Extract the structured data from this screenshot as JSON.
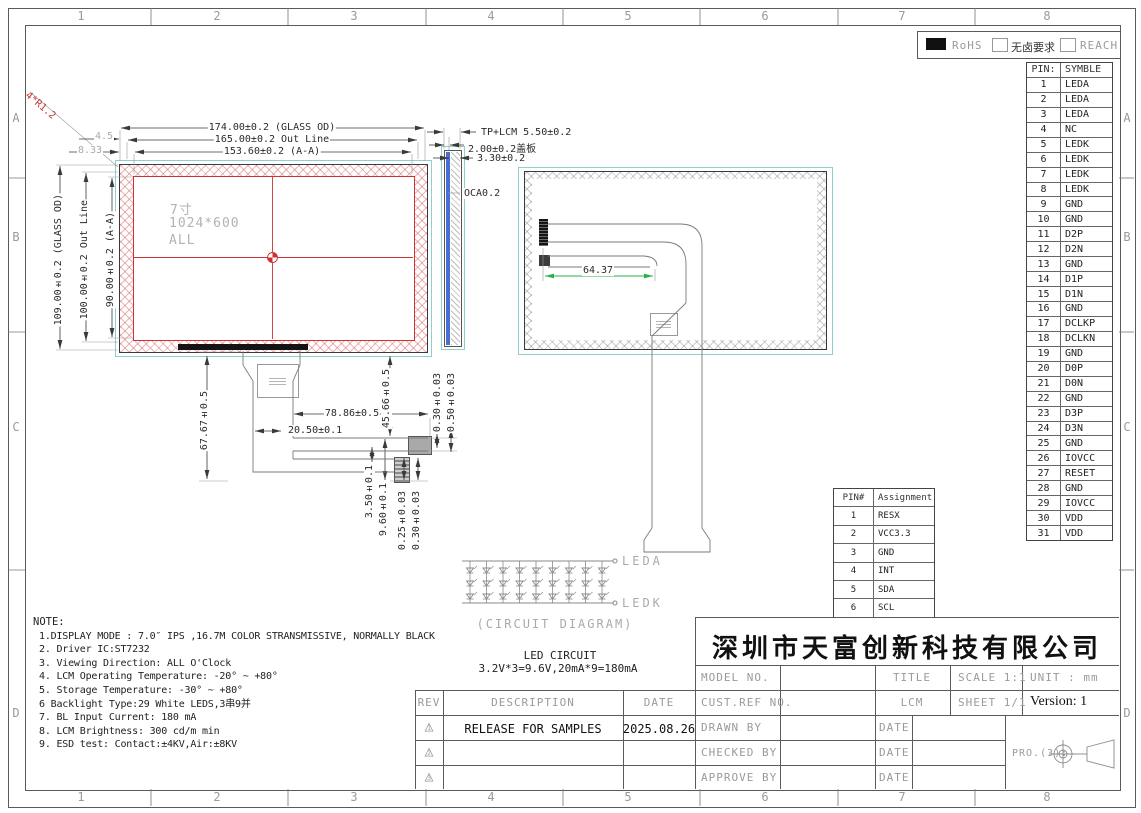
{
  "frame": {
    "columns": [
      "1",
      "2",
      "3",
      "4",
      "5",
      "6",
      "7",
      "8"
    ],
    "rows": [
      "A",
      "B",
      "C",
      "D"
    ]
  },
  "compliance": {
    "items": [
      {
        "label": "RoHS",
        "checked": true
      },
      {
        "label": "无卤要求",
        "checked": false
      },
      {
        "label": "REACH",
        "checked": false
      }
    ]
  },
  "pin_table": {
    "col_pin": "PIN:",
    "col_symbol": "SYMBLE",
    "rows": [
      [
        "1",
        "LEDA"
      ],
      [
        "2",
        "LEDA"
      ],
      [
        "3",
        "LEDA"
      ],
      [
        "4",
        "NC"
      ],
      [
        "5",
        "LEDK"
      ],
      [
        "6",
        "LEDK"
      ],
      [
        "7",
        "LEDK"
      ],
      [
        "8",
        "LEDK"
      ],
      [
        "9",
        "GND"
      ],
      [
        "10",
        "GND"
      ],
      [
        "11",
        "D2P"
      ],
      [
        "12",
        "D2N"
      ],
      [
        "13",
        "GND"
      ],
      [
        "14",
        "D1P"
      ],
      [
        "15",
        "D1N"
      ],
      [
        "16",
        "GND"
      ],
      [
        "17",
        "DCLKP"
      ],
      [
        "18",
        "DCLKN"
      ],
      [
        "19",
        "GND"
      ],
      [
        "20",
        "D0P"
      ],
      [
        "21",
        "D0N"
      ],
      [
        "22",
        "GND"
      ],
      [
        "23",
        "D3P"
      ],
      [
        "24",
        "D3N"
      ],
      [
        "25",
        "GND"
      ],
      [
        "26",
        "IOVCC"
      ],
      [
        "27",
        "RESET"
      ],
      [
        "28",
        "GND"
      ],
      [
        "29",
        "IOVCC"
      ],
      [
        "30",
        "VDD"
      ],
      [
        "31",
        "VDD"
      ]
    ]
  },
  "tp_pin_table": {
    "col_pin": "PIN#",
    "col_assignment": "Assignment",
    "rows": [
      [
        "1",
        "RESX"
      ],
      [
        "2",
        "VCC3.3"
      ],
      [
        "3",
        "GND"
      ],
      [
        "4",
        "INT"
      ],
      [
        "5",
        "SDA"
      ],
      [
        "6",
        "SCL"
      ]
    ]
  },
  "front_view": {
    "screen_size": "7寸",
    "resolution": "1024*600",
    "screen_note": "ALL",
    "dim_width_glass": "174.00±0.2 (GLASS OD)",
    "dim_width_outline": "165.00±0.2 Out Line",
    "dim_width_aa": "153.60±0.2 (A-A)",
    "dim_height_glass": "109.00±0.2 (GLASS OD)",
    "dim_height_outline": "100.00±0.2 Out Line",
    "dim_height_aa": "90.00±0.2 (A-A)",
    "corner_radius": "4*R1.2",
    "corner_dim_1": "4.5",
    "corner_dim_2": "8.33"
  },
  "side_view": {
    "dim_total": "TP+LCM 5.50±0.2",
    "dim_cover": "2.00±0.2盖板",
    "dim_lcm": "3.30±0.2",
    "dim_oca": "OCA0.2"
  },
  "fpc_dims": {
    "length": "67.67±0.5",
    "branch_width": "78.86±0.5",
    "neck_offset": "20.50±0.1",
    "branch_drop": "45.66±0.5",
    "thk_top_1": "0.30±0.03",
    "thk_top_2": "0.50±0.03",
    "gap": "3.50±0.1",
    "tail_len": "9.60±0.1",
    "thk_bot_1": "0.25±0.03",
    "thk_bot_2": "0.30±0.03"
  },
  "back_view": {
    "dim_connector": "64.37"
  },
  "led_circuit": {
    "cols": 9,
    "rows": 3,
    "anode_label": "LEDA",
    "cathode_label": "LEDK",
    "caption": "(CIRCUIT DIAGRAM)",
    "title": "LED CIRCUIT",
    "spec": "3.2V*3=9.6V,20mA*9=180mA"
  },
  "notes": {
    "title": "NOTE:",
    "lines": [
      "1.DISPLAY MODE : 7.0″ IPS ,16.7M COLOR STRANSMISSIVE, NORMALLY BLACK",
      "2. Driver IC:ST7232",
      "3. Viewing Direction: ALL O'Clock",
      "4. LCM Operating Temperature: -20° ~  +80°",
      "5. Storage Temperature: -30° ~  +80°",
      "6 Backlight Type:29 White LEDS,3串9并",
      "7. BL Input Current: 180 mA",
      "8. LCM Brightness: 300 cd/m  min",
      "9. ESD test: Contact:±4KV,Air:±8KV"
    ]
  },
  "rev_table": {
    "col_rev": "REV",
    "col_description": "DESCRIPTION",
    "col_date": "DATE",
    "rows": [
      {
        "rev": "1",
        "description": "RELEASE FOR SAMPLES",
        "date": "2025.08.26"
      },
      {
        "rev": "2",
        "description": "",
        "date": ""
      },
      {
        "rev": "3",
        "description": "",
        "date": ""
      }
    ]
  },
  "title_block": {
    "company": "深圳市天富创新科技有限公司",
    "model_no_label": "MODEL NO.",
    "cust_ref_label": "CUST.REF NO.",
    "title_label": "TITLE",
    "title_value": "LCM",
    "scale": "SCALE 1:1",
    "sheet": "SHEET 1/1",
    "unit": "UNIT : mm",
    "version": "Version: 1",
    "drawn_label": "DRAWN BY",
    "checked_label": "CHECKED BY",
    "approve_label": "APPROVE BY",
    "date_label": "DATE",
    "projection_label": "PRO.(3):"
  }
}
